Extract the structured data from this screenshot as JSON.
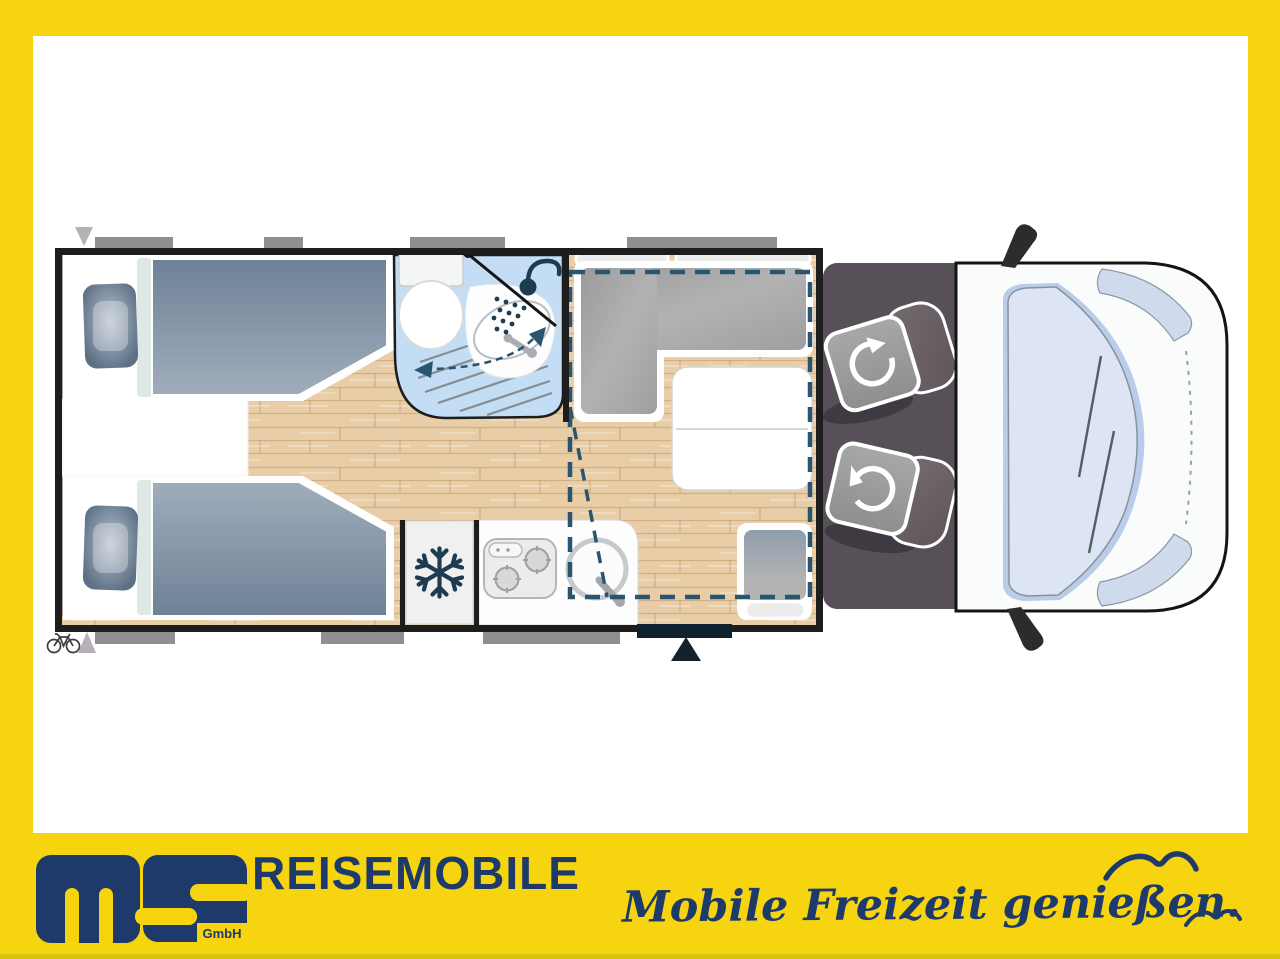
{
  "colors": {
    "yellow": "#f6d40f",
    "yellow-dark": "#d9c40d",
    "navy": "#1d3a6b",
    "plan-wall": "#1d1d1d",
    "wood": "#e8cda6",
    "mattress": "#7e8fa3",
    "pillow": "#5d7086",
    "bath-blue": "#c3ddf4",
    "dashed-outline": "#2a5570",
    "cushion-gray": "#a9a9a9",
    "cab-floor": "#575058",
    "seat-gray": "#9c9c9c",
    "backrest-gray": "#6d6369",
    "window-bar": "#8f8f8f",
    "door-bar": "#10222e",
    "windshield": "#dde5f5",
    "icon-navy": "#1d3c52"
  },
  "footer": {
    "logo": {
      "text": "ms",
      "suffix": "GmbH"
    },
    "brand_line": "REISEMOBILE",
    "slogan": "Mobile Freizeit genießen."
  },
  "floorplan": {
    "icons": [
      "snowflake-icon",
      "shower-icon",
      "swivel-arrow-icon",
      "bicycle-icon",
      "entry-arrow-icon",
      "window-marker",
      "entry-door-marker",
      "seagull-icon"
    ]
  }
}
